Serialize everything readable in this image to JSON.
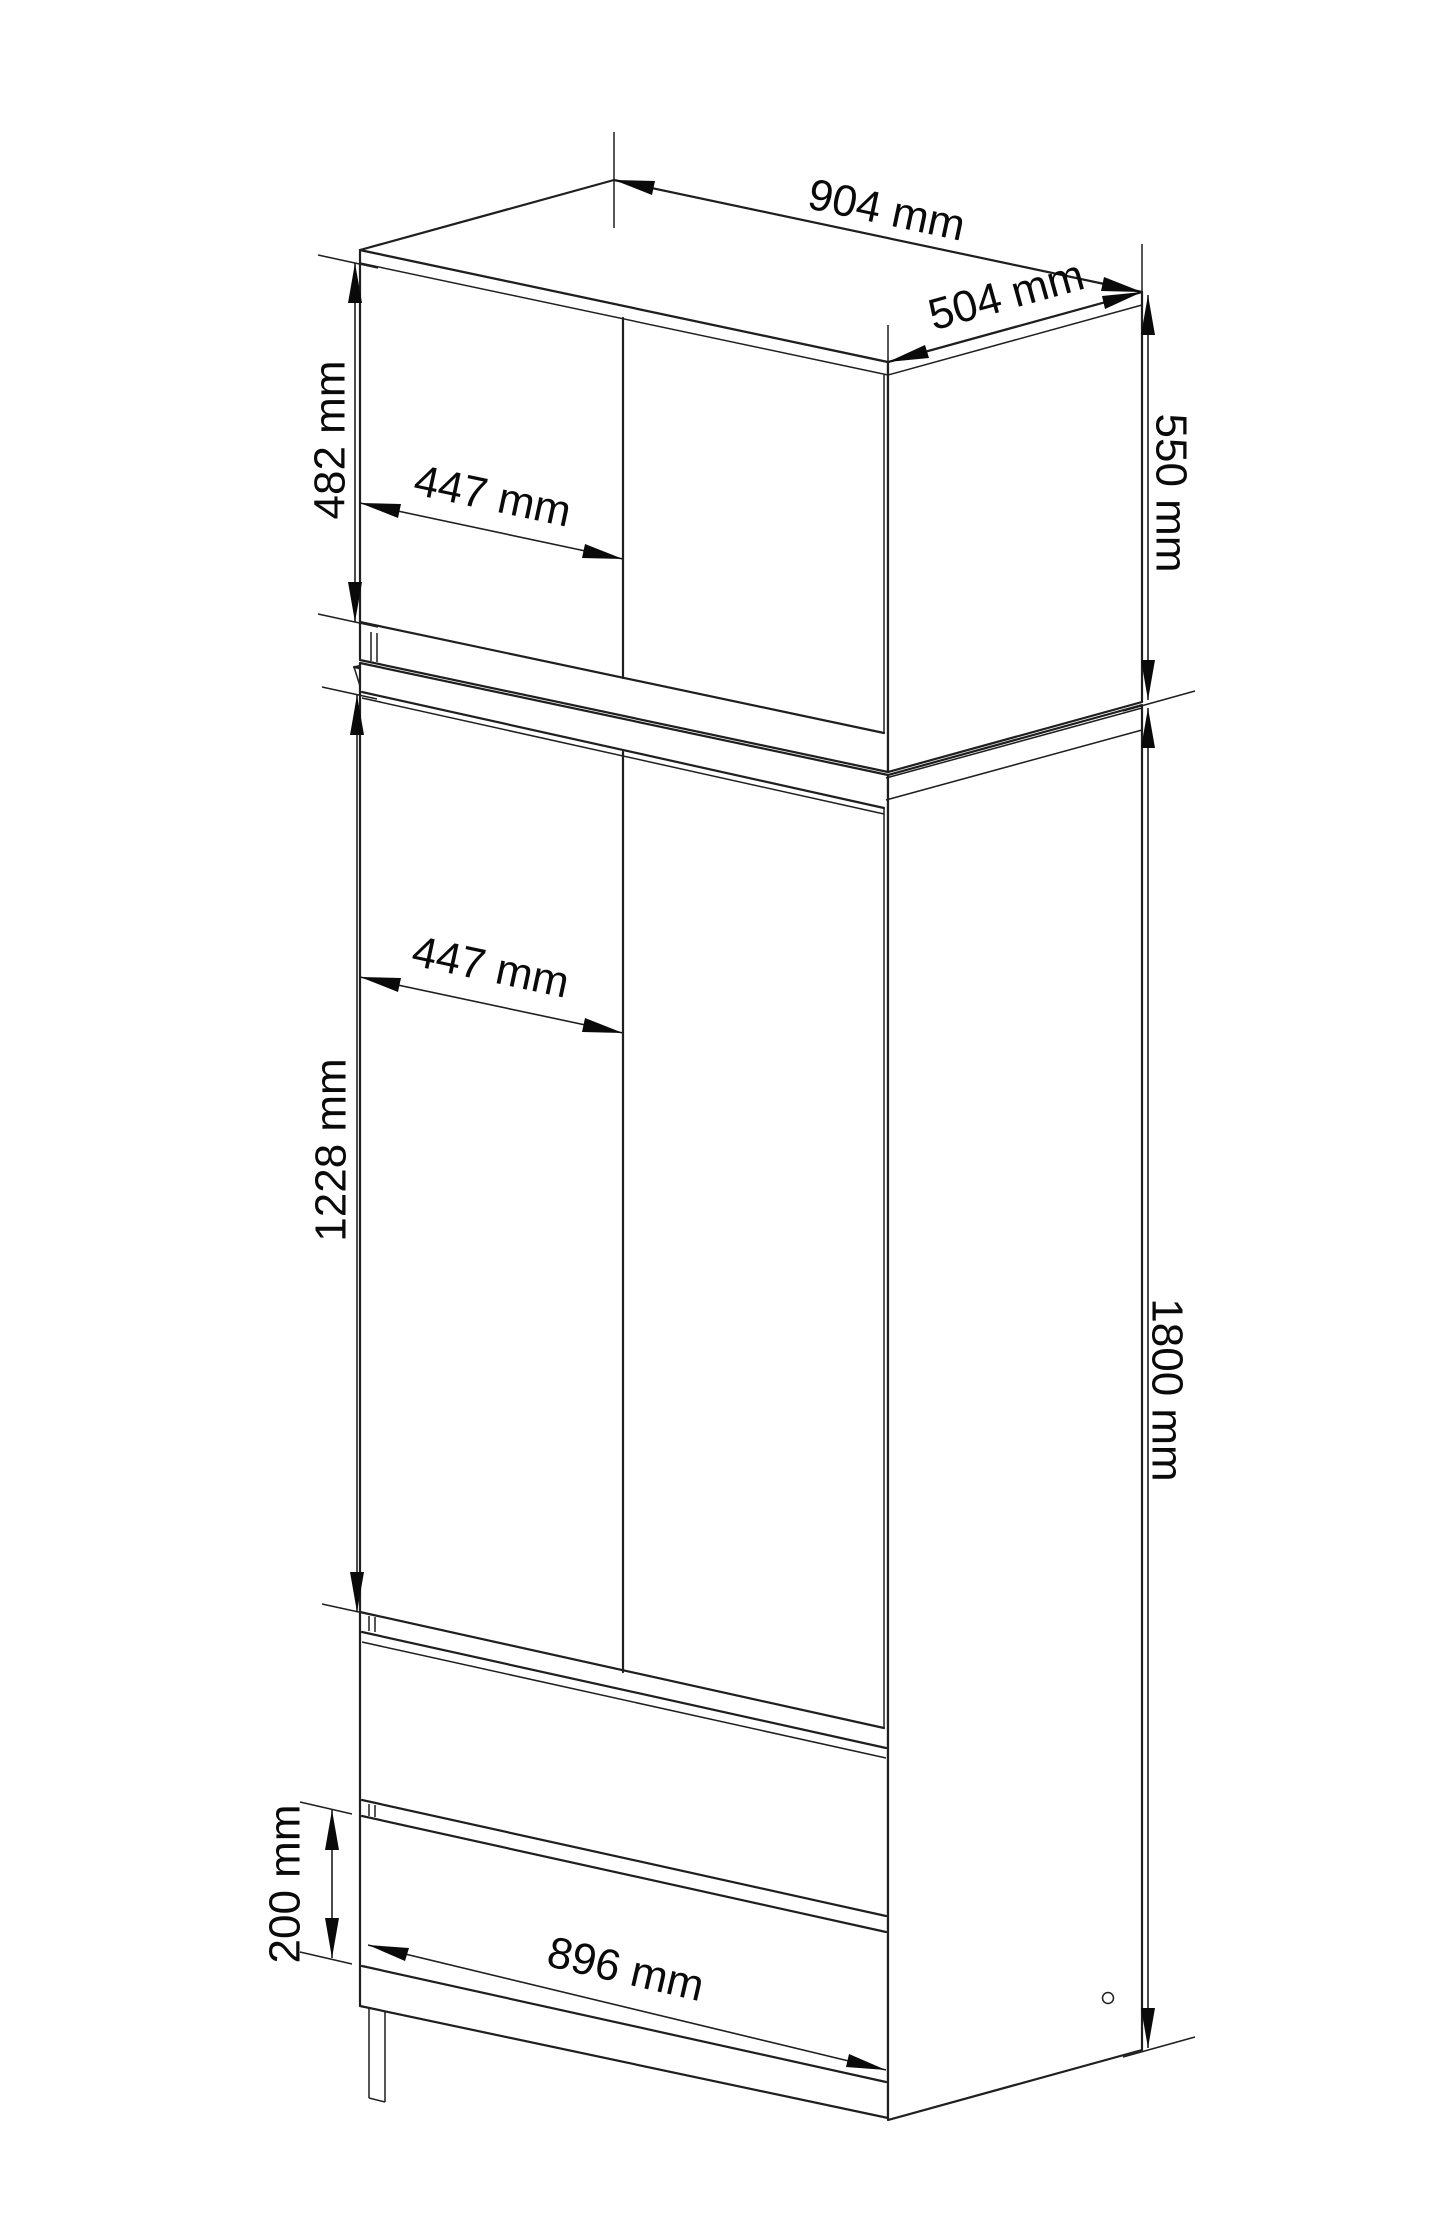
{
  "drawing": {
    "kind": "furniture-technical-drawing",
    "subject": "two-door wardrobe with top cabinet and two drawers",
    "unit": "mm",
    "colors": {
      "line": "#1f1f1f",
      "background": "#ffffff"
    },
    "labels": {
      "top_width": "904 mm",
      "top_depth": "504 mm",
      "top_height": "550 mm",
      "top_door_width": "447 mm",
      "top_door_height": "482 mm",
      "main_door_width": "447 mm",
      "main_door_height": "1228 mm",
      "main_height": "1800 mm",
      "drawer_front_height": "200 mm",
      "drawer_front_width": "896 mm"
    }
  }
}
